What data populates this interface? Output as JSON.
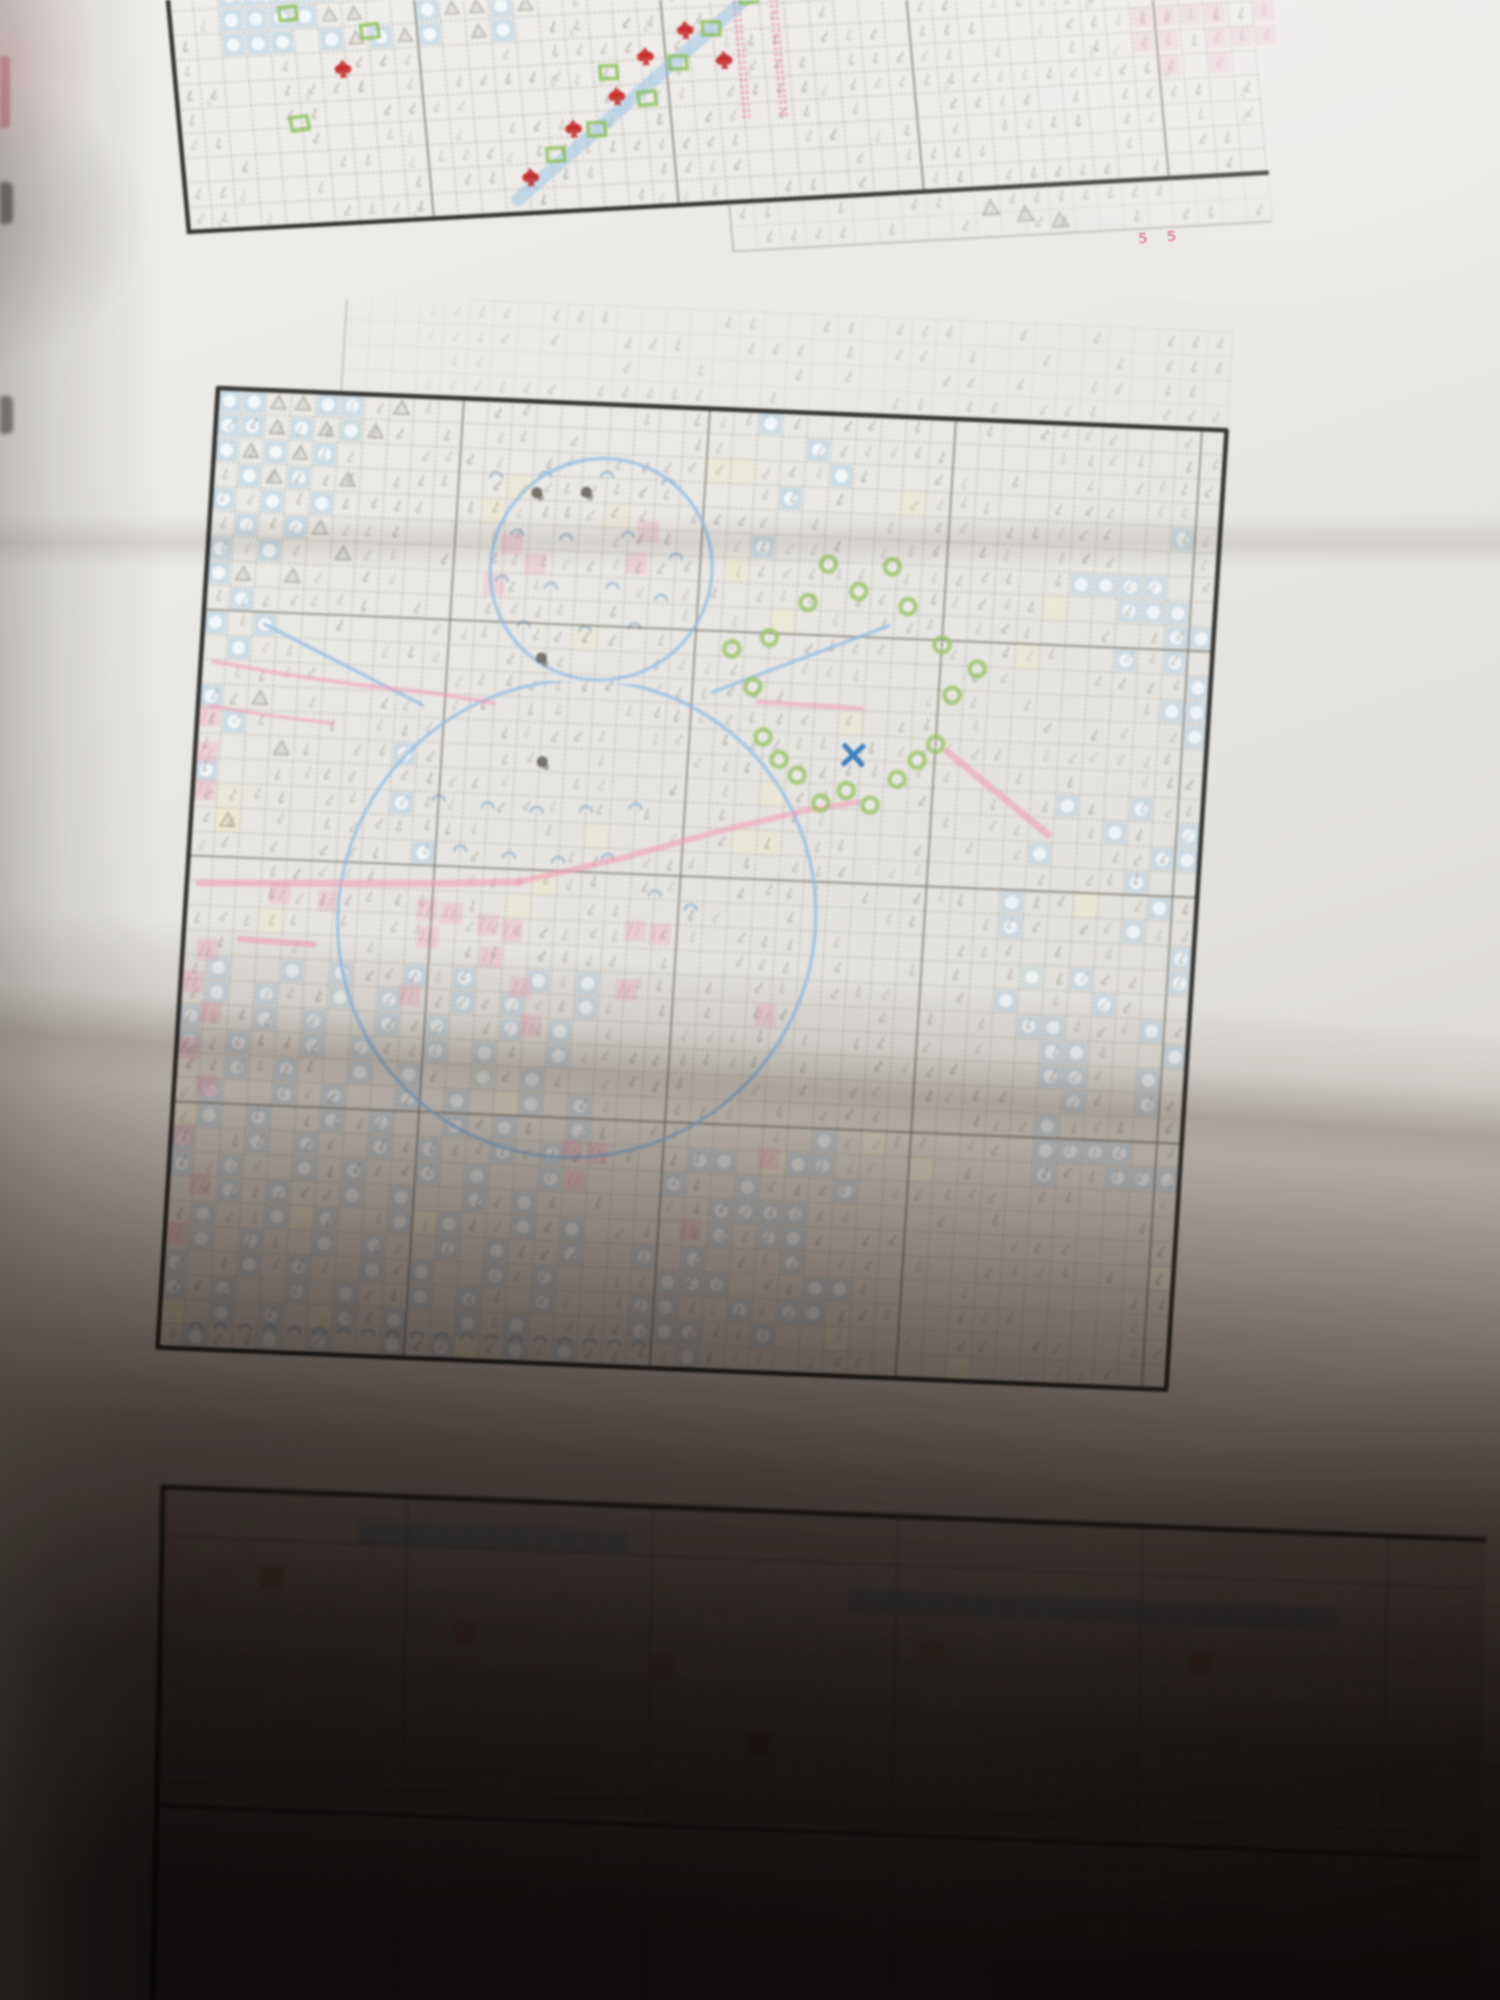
{
  "scene": {
    "type": "photograph",
    "subject": "printed cross-stitch pattern chart pages of a snowman design on a folded paper sheet",
    "sections_visible": 3,
    "page_number_text": "5 5",
    "paper_color": "#e8e6e2",
    "lighting": "bright at top, deep shadow over bottom third, darkest at bottom right",
    "fold_creases_y": [
      520,
      1120
    ]
  },
  "palette": {
    "grid": "#9a958c",
    "grid_bold": "#77736b",
    "border": "#2b2a28",
    "glyph": "#8b867c",
    "triangle": "#8d8880",
    "blue_cell": "#aecde4",
    "blue_glyph": "#7fa8cc",
    "bright_blue": "#2f7bc0",
    "pink_cell": "#eeb4c4",
    "pink_line": "#f0a0b8",
    "red": "#c62828",
    "green_square": "#8bbf5c",
    "green_ring": "#9cc46a",
    "cream": "#efeacc",
    "dark_spot": "#5a564f"
  },
  "texture_seed": 7,
  "chart_data": [
    {
      "kind": "top",
      "name": "top-chart-section",
      "type": "heatmap",
      "title": "bottom rows of upper pattern page",
      "transform": [
        1,
        -0.055,
        0.09,
        1,
        168,
        0
      ],
      "cell": 24.5,
      "cols": 44,
      "top_px": -40,
      "bottom_px": 232,
      "motifs": {
        "sky_block": {
          "col_range": [
            2,
            14
          ],
          "y_max": 58
        },
        "green_squares": [
          [
            118,
            20
          ],
          [
            198,
            42
          ],
          [
            120,
            130
          ],
          [
            372,
            175
          ],
          [
            415,
            152
          ],
          [
            468,
            124
          ],
          [
            432,
            96
          ],
          [
            502,
            90
          ],
          [
            538,
            58
          ],
          [
            578,
            28
          ]
        ],
        "red_spades": [
          [
            168,
            78
          ],
          [
            392,
            150
          ],
          [
            438,
            120
          ],
          [
            345,
            196
          ],
          [
            470,
            82
          ],
          [
            512,
            58
          ],
          [
            548,
            90
          ]
        ],
        "blue_band": [
          [
            330,
            218
          ],
          [
            595,
            15
          ]
        ],
        "pink_columns_x": [
          563,
          600
        ],
        "pink_hatch": {
          "x_range": [
            930,
            1078
          ],
          "y_range": [
            -40,
            120
          ]
        },
        "corner_triangles": [
          [
            800,
            252
          ],
          [
            834,
            260
          ],
          [
            868,
            268
          ]
        ],
        "overlap_rows_below": 2,
        "overlap_x_start": 540
      }
    },
    {
      "kind": "middle",
      "name": "middle-chart-section-snowman",
      "type": "heatmap",
      "title": "snowman page with wreath, scarf and falling snow",
      "transform": [
        1,
        0.042,
        -0.063,
        1,
        218,
        88
      ],
      "cell": 24.6,
      "cols": 41,
      "rows": 39,
      "motifs": {
        "overlap_rows_above": 4,
        "overlap_col_start": 5,
        "sky_cells": [
          [
            0,
            0
          ],
          [
            1,
            0
          ],
          [
            4,
            0
          ],
          [
            5,
            0
          ],
          [
            0,
            1
          ],
          [
            1,
            1
          ],
          [
            3,
            1
          ],
          [
            5,
            1
          ],
          [
            0,
            2
          ],
          [
            2,
            2
          ],
          [
            4,
            2
          ],
          [
            1,
            3
          ],
          [
            3,
            3
          ],
          [
            0,
            4
          ],
          [
            2,
            4
          ],
          [
            4,
            4
          ],
          [
            1,
            5
          ],
          [
            3,
            5
          ],
          [
            0,
            6
          ],
          [
            2,
            6
          ],
          [
            0,
            7
          ],
          [
            1,
            8
          ],
          [
            0,
            9
          ],
          [
            2,
            9
          ],
          [
            1,
            10
          ],
          [
            0,
            12
          ],
          [
            1,
            13
          ],
          [
            0,
            15
          ],
          [
            22,
            0
          ],
          [
            24,
            1
          ],
          [
            23,
            3
          ],
          [
            25,
            2
          ],
          [
            22,
            5
          ],
          [
            8,
            14
          ],
          [
            8,
            16
          ],
          [
            9,
            18
          ]
        ],
        "triangle_cells": [
          [
            2,
            0
          ],
          [
            3,
            0
          ],
          [
            2,
            1
          ],
          [
            4,
            1
          ],
          [
            1,
            2
          ],
          [
            3,
            2
          ],
          [
            5,
            3
          ],
          [
            2,
            3
          ],
          [
            4,
            5
          ],
          [
            5,
            6
          ],
          [
            1,
            7
          ],
          [
            3,
            7
          ],
          [
            2,
            12
          ],
          [
            3,
            14
          ],
          [
            1,
            17
          ],
          [
            6,
            1
          ],
          [
            7,
            0
          ]
        ],
        "head": {
          "c": 15.5,
          "r": 6.2,
          "rad": 4.5
        },
        "body": {
          "c": 15.4,
          "r": 20.4,
          "rad": 9.7,
          "clip_row": 11.3
        },
        "arms": [
          [
            [
              20.3,
              11.0
            ],
            [
              27.3,
              8.0
            ]
          ],
          [
            [
              8.6,
              12.0
            ],
            [
              2.0,
              9.0
            ]
          ]
        ],
        "dark_spots": [
          [
            12.7,
            3.2
          ],
          [
            14.7,
            3.1
          ],
          [
            13.3,
            9.9
          ],
          [
            13.6,
            14.1
          ]
        ],
        "blush_cells": [
          [
            11.8,
            5.3
          ],
          [
            12.8,
            6.1
          ],
          [
            17.3,
            4.6
          ],
          [
            16.9,
            5.9
          ],
          [
            11.2,
            7.0
          ]
        ],
        "pink_cells": [
          [
            9.3,
            20.3
          ],
          [
            10.3,
            20.4
          ],
          [
            9.4,
            21.4
          ],
          [
            11.8,
            20.8
          ],
          [
            12.8,
            21.0
          ],
          [
            12.0,
            22.1
          ],
          [
            17.8,
            20.8
          ],
          [
            18.8,
            20.9
          ],
          [
            13.3,
            23.3
          ],
          [
            17.6,
            23.2
          ],
          [
            8.8,
            23.8
          ],
          [
            13.8,
            24.8
          ],
          [
            23.3,
            24.0
          ],
          [
            0,
            12.8
          ],
          [
            0,
            14.3
          ],
          [
            0,
            15.8
          ],
          [
            0.5,
            22.3
          ],
          [
            0,
            23.6
          ],
          [
            0.8,
            24.8
          ],
          [
            0,
            26.3
          ],
          [
            0.8,
            27.8
          ],
          [
            0,
            29.8
          ],
          [
            0.8,
            31.8
          ],
          [
            0,
            33.8
          ],
          [
            15.8,
            29.8
          ],
          [
            16.8,
            29.9
          ],
          [
            16.0,
            31.0
          ],
          [
            20.8,
            32.8
          ],
          [
            23.8,
            29.8
          ],
          [
            3.3,
            19.9
          ],
          [
            5.3,
            20.1
          ]
        ],
        "scarf_lines": [
          {
            "pts": [
              [
                0,
                10.6
              ],
              [
                3,
                11.0
              ],
              [
                6,
                11.3
              ],
              [
                9,
                11.5
              ],
              [
                11.5,
                11.8
              ]
            ],
            "w": 4
          },
          {
            "pts": [
              [
                0,
                12.4
              ],
              [
                2.5,
                12.7
              ],
              [
                5,
                12.9
              ]
            ],
            "w": 3.5
          },
          {
            "pts": [
              [
                0,
                19.6
              ],
              [
                5,
                19.4
              ],
              [
                10,
                19.2
              ],
              [
                13,
                19.0
              ]
            ],
            "w": 7
          },
          {
            "pts": [
              [
                13,
                19.0
              ],
              [
                17,
                17.9
              ],
              [
                21,
                16.6
              ],
              [
                24.5,
                15.6
              ],
              [
                26.5,
                15.2
              ]
            ],
            "w": 6
          },
          {
            "pts": [
              [
                1.8,
                21.8
              ],
              [
                4.8,
                21.9
              ]
            ],
            "w": 6
          },
          {
            "pts": [
              [
                22.2,
                11.3
              ],
              [
                26.4,
                11.4
              ]
            ],
            "w": 4.5
          },
          {
            "pts": [
              [
                30.0,
                13.0
              ],
              [
                34.3,
                16.2
              ]
            ],
            "w": 7
          }
        ],
        "wreath_rings": [
          [
            30.05,
            10.7
          ],
          [
            29.51,
            12.72
          ],
          [
            28.03,
            14.21
          ],
          [
            26,
            14.75
          ],
          [
            23.97,
            14.21
          ],
          [
            22.49,
            12.72
          ],
          [
            21.95,
            10.7
          ],
          [
            22.49,
            8.68
          ],
          [
            23.97,
            7.19
          ],
          [
            26,
            6.65
          ],
          [
            28.03,
            7.19
          ],
          [
            29.51,
            8.68
          ],
          [
            24.7,
            5.6
          ],
          [
            27.3,
            5.6
          ],
          [
            21.0,
            9.2
          ],
          [
            31.0,
            9.6
          ],
          [
            23.2,
            13.6
          ],
          [
            28.8,
            13.4
          ],
          [
            25.0,
            15.3
          ],
          [
            27.0,
            15.3
          ]
        ],
        "blue_x": [
          26.2,
          13.3
        ],
        "u_cells": [
          [
            11,
            2.6
          ],
          [
            13,
            2.5
          ],
          [
            15.5,
            2.4
          ],
          [
            18,
            2.6
          ],
          [
            12,
            4.9
          ],
          [
            14,
            5.0
          ],
          [
            16.5,
            4.8
          ],
          [
            18.5,
            5.6
          ],
          [
            11.5,
            6.8
          ],
          [
            13.5,
            7.0
          ],
          [
            16,
            6.9
          ],
          [
            18,
            7.3
          ],
          [
            12.5,
            8.6
          ],
          [
            15,
            8.7
          ],
          [
            17,
            8.5
          ],
          [
            9.5,
            15.8
          ],
          [
            11.5,
            16.0
          ],
          [
            13.5,
            16.1
          ],
          [
            15.5,
            16.0
          ],
          [
            17.5,
            15.8
          ],
          [
            10.5,
            17.8
          ],
          [
            12.5,
            18.0
          ],
          [
            14.5,
            18.1
          ],
          [
            16.5,
            17.9
          ],
          [
            18.5,
            19.3
          ],
          [
            20,
            19.8
          ]
        ],
        "bottom_u_row": {
          "row": 37.6,
          "col_range": [
            1,
            19
          ]
        },
        "blue_regions": [
          {
            "cols": [
              0,
              17
            ],
            "rows": [
              23,
              39
            ],
            "mode": "diag"
          },
          {
            "cols": [
              18,
              28
            ],
            "rows": [
              29,
              39
            ],
            "mode": "sparse"
          },
          {
            "cols": [
              33,
              41
            ],
            "rows": [
              15,
              31
            ],
            "mode": "sparse"
          },
          {
            "cols": [
              35,
              41
            ],
            "rows": [
              3,
              13
            ],
            "mode": "sparse"
          }
        ],
        "cream_count": 42
      }
    },
    {
      "kind": "bottom",
      "name": "bottom-chart-section-in-shadow",
      "type": "heatmap",
      "title": "top rows of next pattern page, in deep shadow",
      "transform": [
        1,
        0.04,
        -0.02,
        1,
        163,
        87
      ],
      "cell": 24.5,
      "cols": 54,
      "rows": 22,
      "motifs": {
        "blue_bands": [
          {
            "row": 1,
            "col_range": [
              8,
              19
            ]
          },
          {
            "row": 3,
            "col_range": [
              28,
              48
            ]
          }
        ],
        "pink_cells": [
          [
            0,
            1
          ],
          [
            1,
            1
          ],
          [
            0,
            2
          ],
          [
            2,
            3
          ],
          [
            1,
            4
          ],
          [
            3,
            2
          ]
        ],
        "red_cells": [
          [
            4,
            3
          ],
          [
            12,
            5
          ],
          [
            20,
            6
          ],
          [
            31,
            5
          ],
          [
            42,
            5
          ],
          [
            24,
            9
          ]
        ],
        "triangle_rows": {
          "rows": [
            2,
            9
          ],
          "density": 0.25
        },
        "dot_region": {
          "cols": [
            0,
            54
          ],
          "rows": [
            4,
            20
          ]
        },
        "bold_row": 13
      }
    }
  ]
}
